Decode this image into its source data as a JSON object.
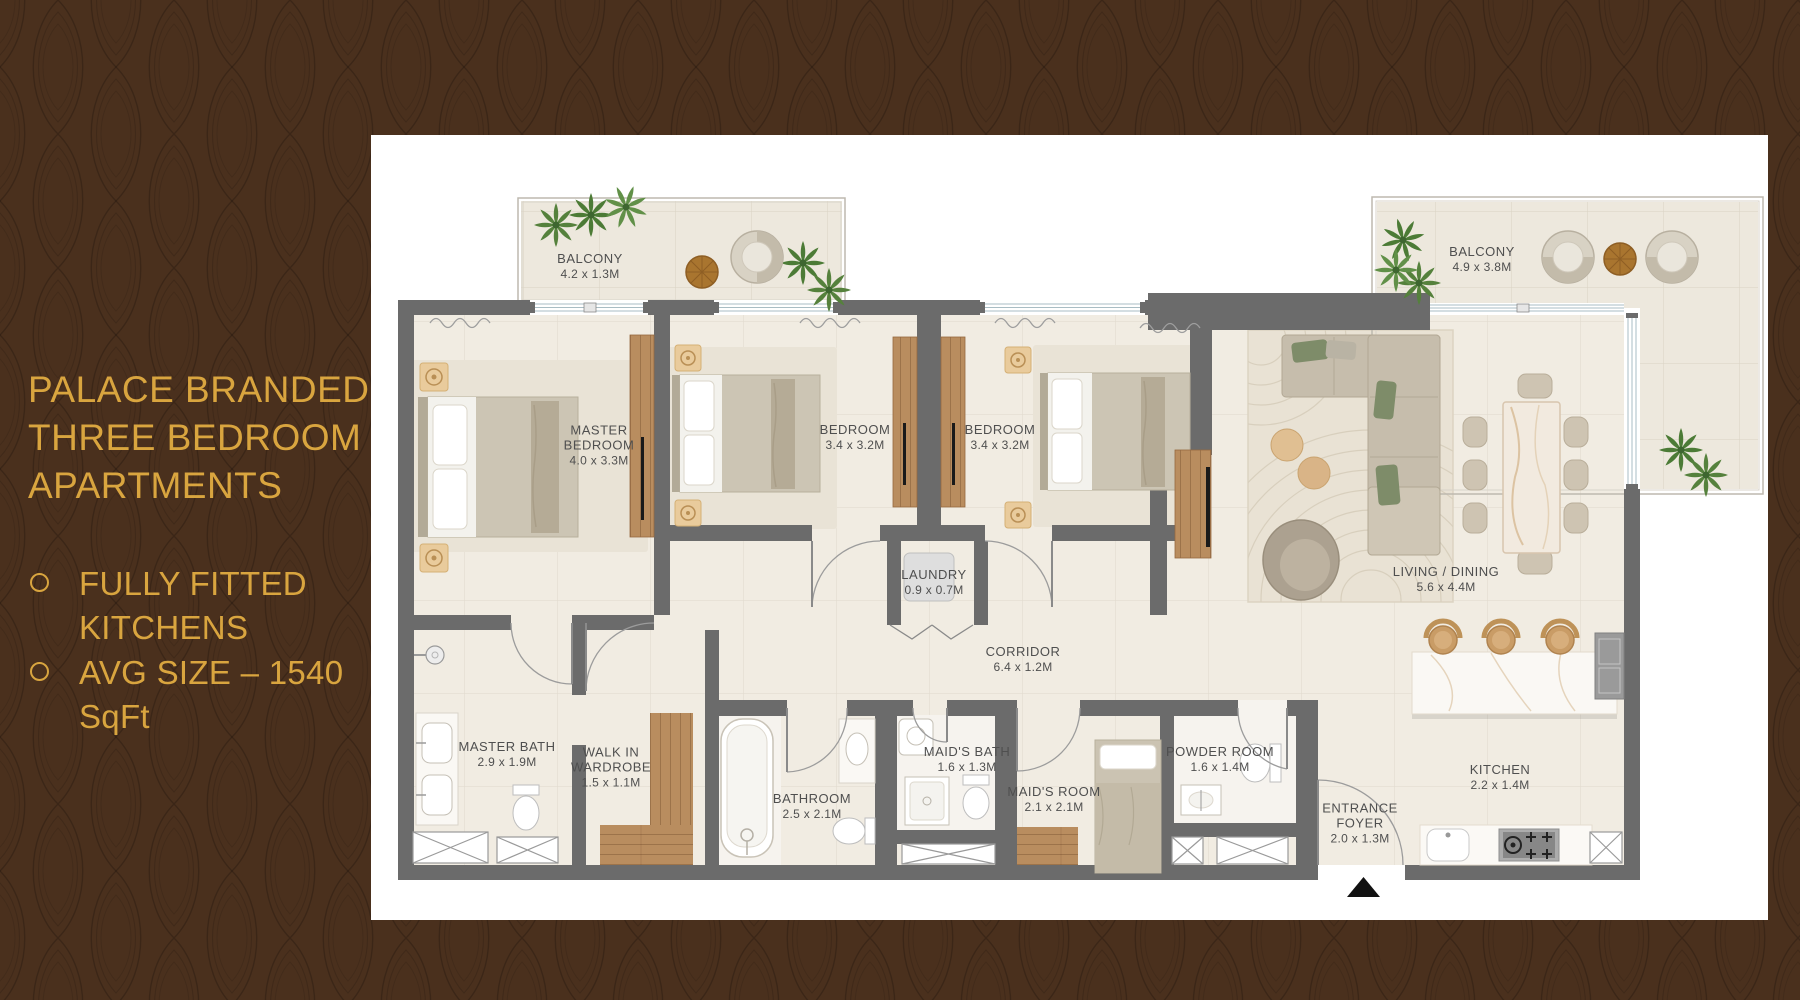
{
  "slide": {
    "title": "PALACE BRANDED\nTHREE BEDROOM\nAPARTMENTS",
    "bullets": [
      "FULLY FITTED\nKITCHENS",
      "AVG SIZE – 1540\nSqFt"
    ],
    "colors": {
      "background_brown": "#4A301D",
      "accent_gold": "#D9A53F",
      "wall_grey": "#6B6B6B",
      "label_grey": "#4F4F4F",
      "floor_cream": "#F1ECE2",
      "wood": "#B98D5F",
      "plant_green": "#55813C"
    }
  },
  "floor_plan": {
    "panel_background": "#FFFFFF",
    "entrance_marker": "entrance-arrow",
    "rooms": [
      {
        "key": "balcony-1",
        "name": "BALCONY",
        "dims": "4.2 x 1.3M"
      },
      {
        "key": "master-bedroom",
        "name": "MASTER\nBEDROOM",
        "dims": "4.0 x 3.3M"
      },
      {
        "key": "bedroom-2",
        "name": "BEDROOM",
        "dims": "3.4 x 3.2M"
      },
      {
        "key": "bedroom-3",
        "name": "BEDROOM",
        "dims": "3.4 x 3.2M"
      },
      {
        "key": "balcony-2",
        "name": "BALCONY",
        "dims": "4.9 x 3.8M"
      },
      {
        "key": "laundry",
        "name": "LAUNDRY",
        "dims": "0.9 x 0.7M"
      },
      {
        "key": "corridor",
        "name": "CORRIDOR",
        "dims": "6.4 x 1.2M"
      },
      {
        "key": "living-dining",
        "name": "LIVING / DINING",
        "dims": "5.6 x 4.4M"
      },
      {
        "key": "master-bath",
        "name": "MASTER BATH",
        "dims": "2.9 x 1.9M"
      },
      {
        "key": "walk-in-wardrobe",
        "name": "WALK IN\nWARDROBE",
        "dims": "1.5 x 1.1M"
      },
      {
        "key": "bathroom",
        "name": "BATHROOM",
        "dims": "2.5 x 2.1M"
      },
      {
        "key": "maids-bath",
        "name": "MAID'S BATH",
        "dims": "1.6 x 1.3M"
      },
      {
        "key": "maids-room",
        "name": "MAID'S ROOM",
        "dims": "2.1 x 2.1M"
      },
      {
        "key": "powder-room",
        "name": "POWDER ROOM",
        "dims": "1.6 x 1.4M"
      },
      {
        "key": "entrance-foyer",
        "name": "ENTRANCE\nFOYER",
        "dims": "2.0 x 1.3M"
      },
      {
        "key": "kitchen",
        "name": "KITCHEN",
        "dims": "2.2 x 1.4M"
      }
    ]
  }
}
